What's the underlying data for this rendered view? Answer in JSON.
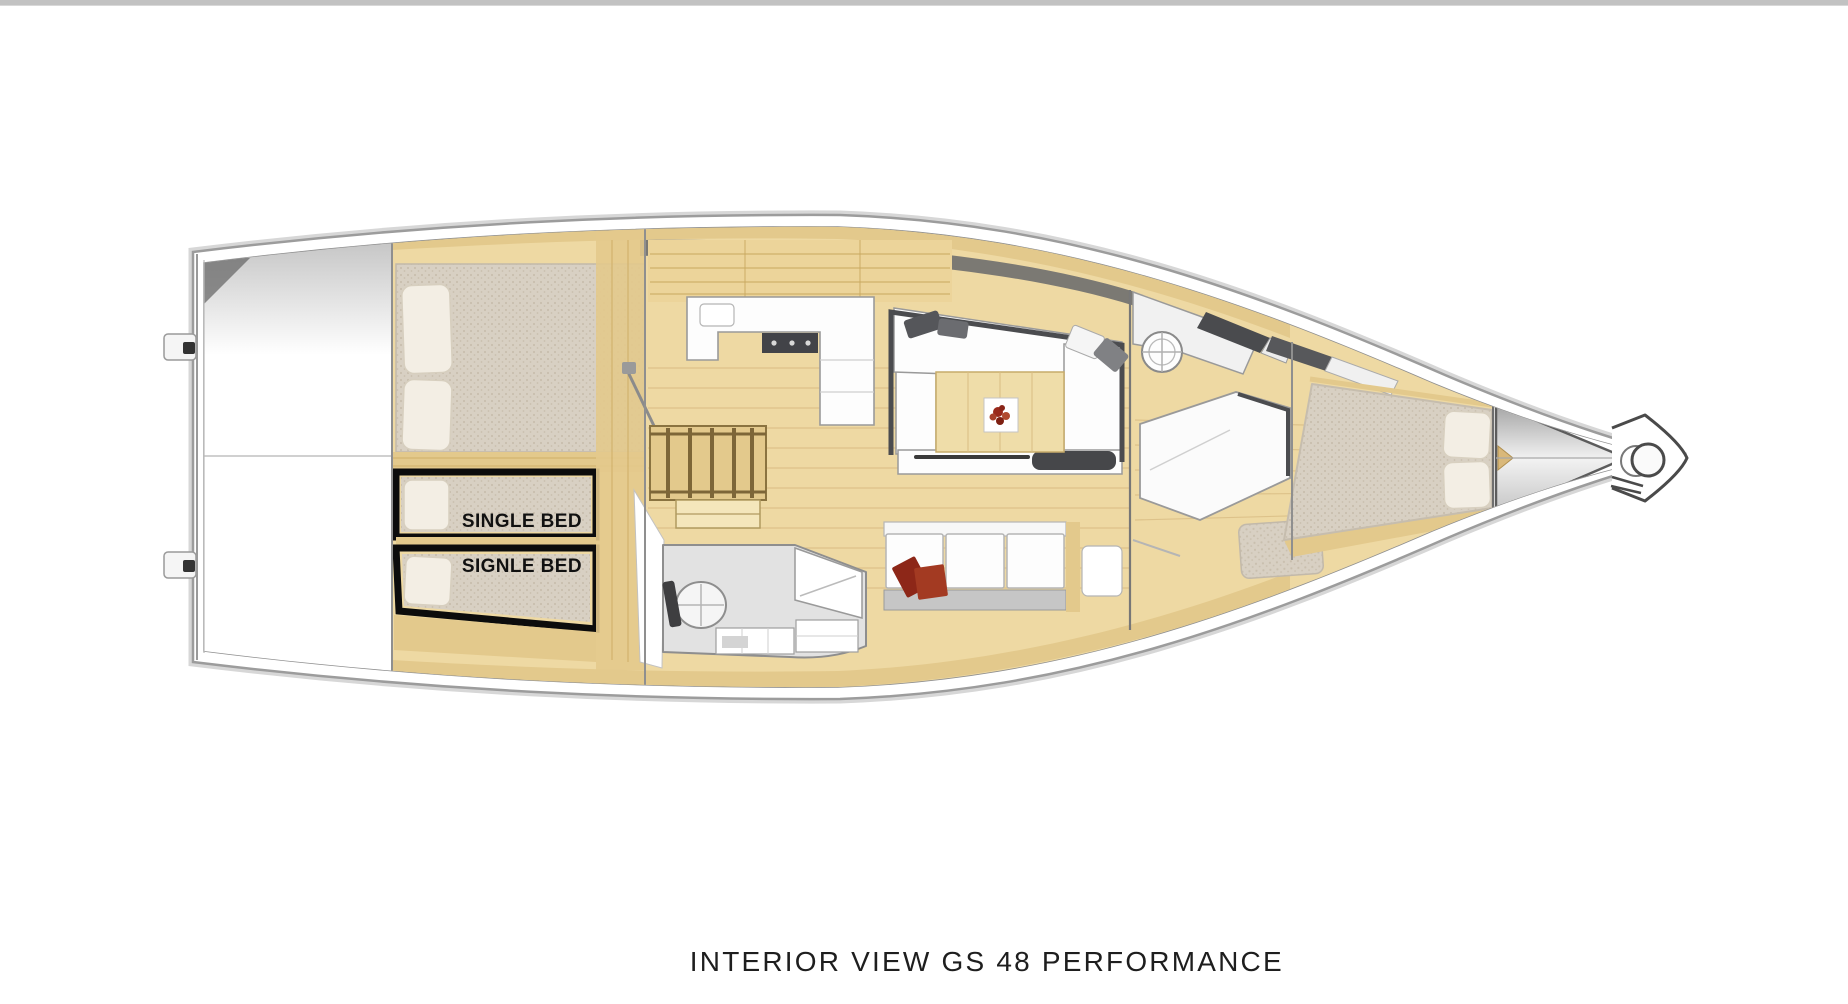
{
  "page": {
    "top_bar_color": "#c2c2c2",
    "background_color": "#ffffff"
  },
  "floorplan": {
    "bed_labels": {
      "upper": "SINGLE BED",
      "lower": "SIGNLE BED"
    },
    "caption": "INTERIOR VIEW GS 48 PERFORMANCE",
    "colors": {
      "top_bar": "#c2c2c2",
      "wood_floor": "#eed9a3",
      "wood_trim": "#e3c98c",
      "wood_light": "#f4e6bb",
      "plank_line": "#d9bd84",
      "mattress": "#d8d0c3",
      "mattress_dot": "#c9bfae",
      "pillow": "#f3eee4",
      "hull_stroke": "#9c9c9c",
      "hull_stroke_light": "#d7d7d7",
      "deck_stroke": "#8f8f8f",
      "shadow_dark": "#6e6e6e",
      "furniture_white": "#fdfdfd",
      "furniture_stroke": "#9a9a9a",
      "frame_dark": "#4b4c4f",
      "cabinet_wood": "#ecd49a",
      "cabinet_line": "#c9a85f",
      "bath_gray": "#e2e2e2",
      "label_box": "#0c0c0c",
      "label_text": "#111111",
      "accent_red": "#99291b",
      "accent_red_light": "#b04a2f",
      "caption_color": "#1e1e1e"
    }
  }
}
